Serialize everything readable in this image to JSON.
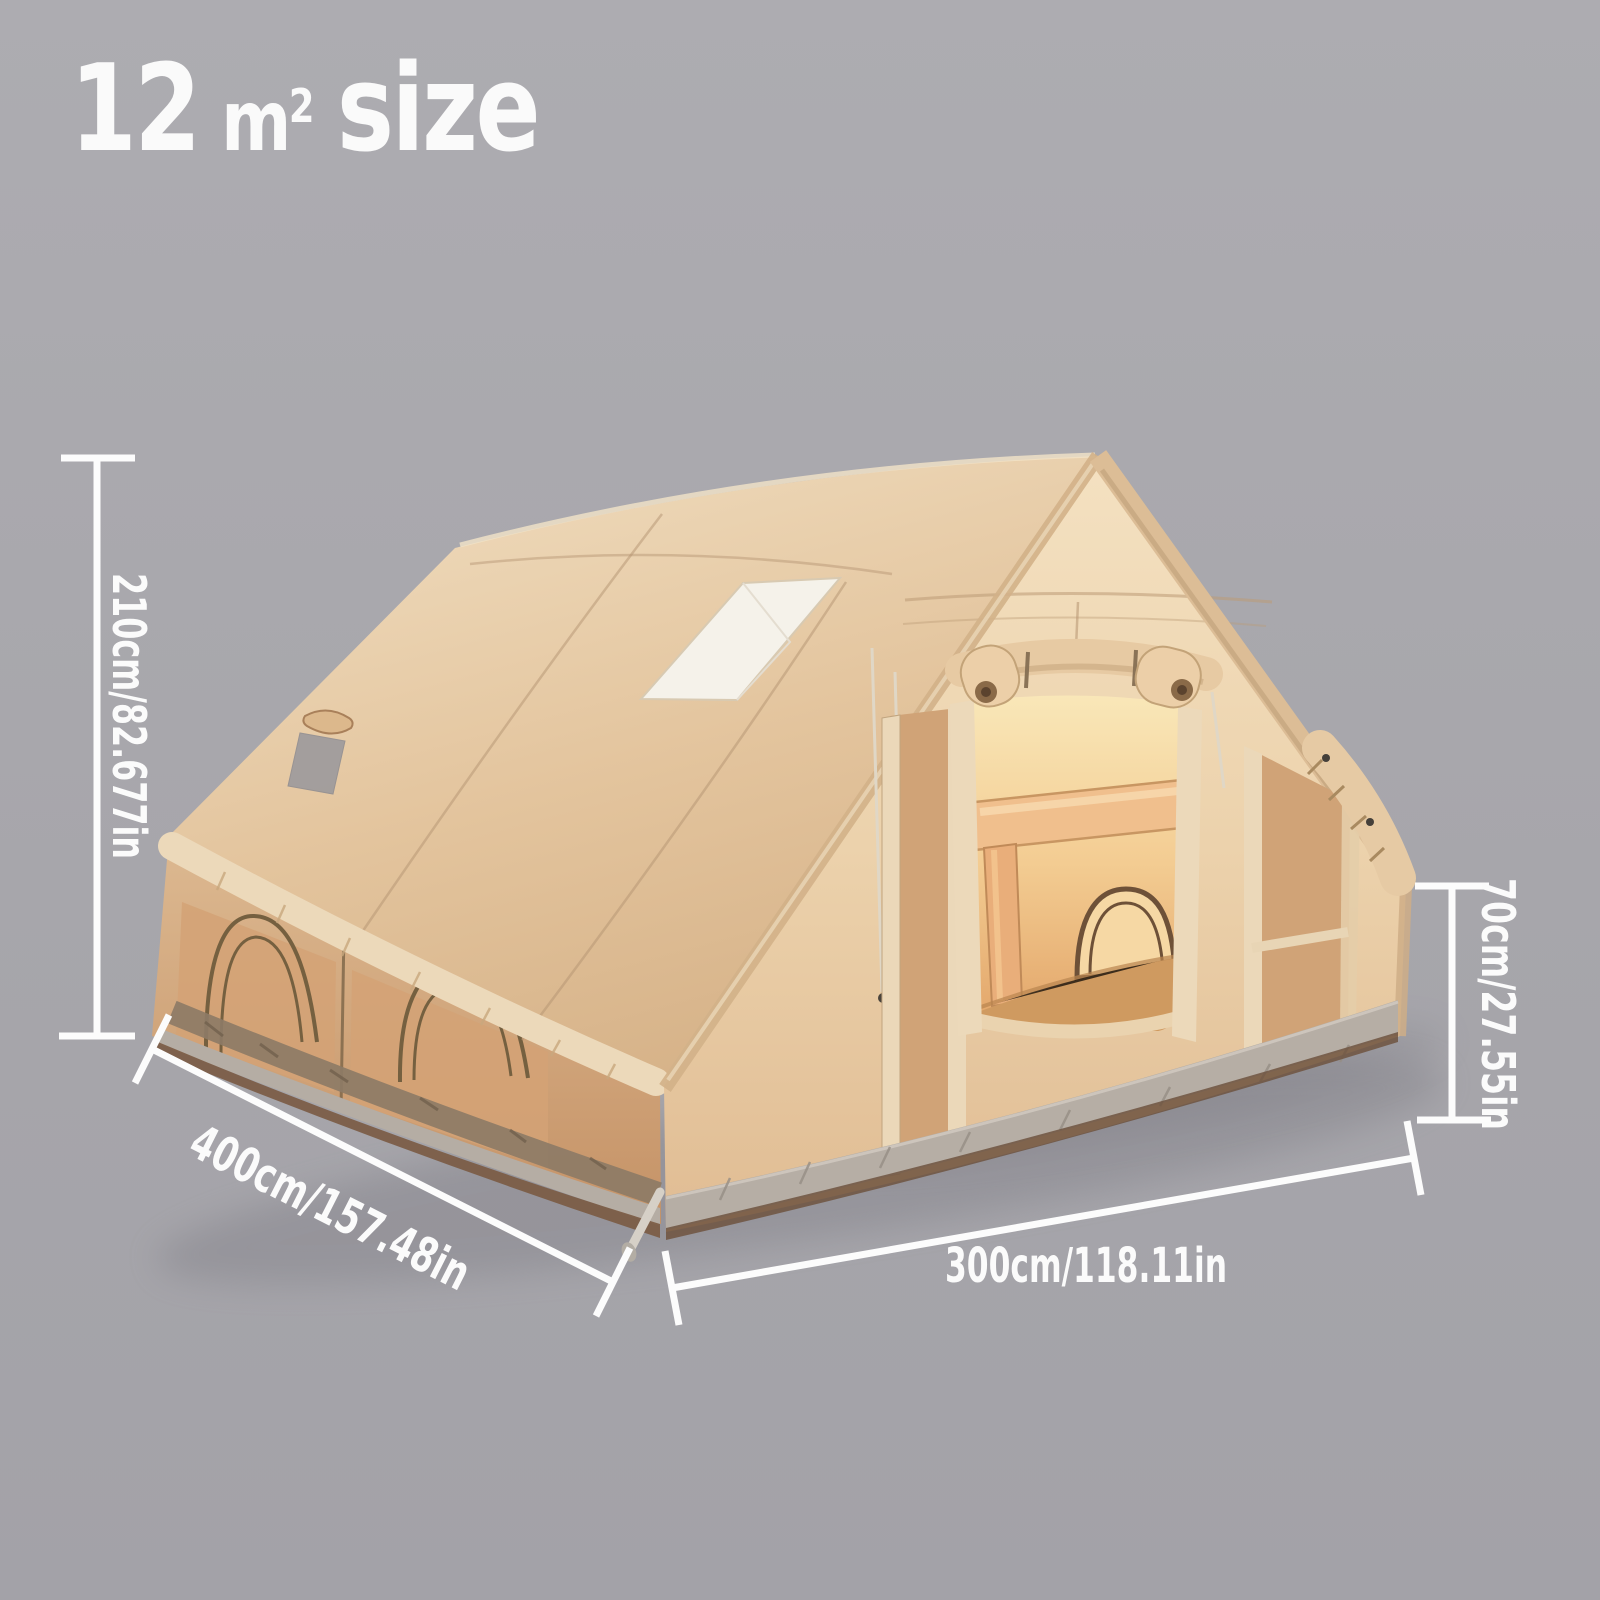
{
  "title": {
    "value": "12",
    "unit_base": "m",
    "unit_exponent": "2",
    "label": "size"
  },
  "dimensions": {
    "height": "210cm/82.677in",
    "side": "400cm/157.48in",
    "width": "300cm/118.11in",
    "side_wall_height": "70cm/27.55in"
  },
  "colors": {
    "background": "#a8a7ac",
    "text": "#fafafa",
    "dimension_line": "#fcfcfc",
    "tent_canvas": "#e6c9a3",
    "tent_interior_glow": "#f3cc92",
    "tent_skirt": "#b6aea5"
  }
}
